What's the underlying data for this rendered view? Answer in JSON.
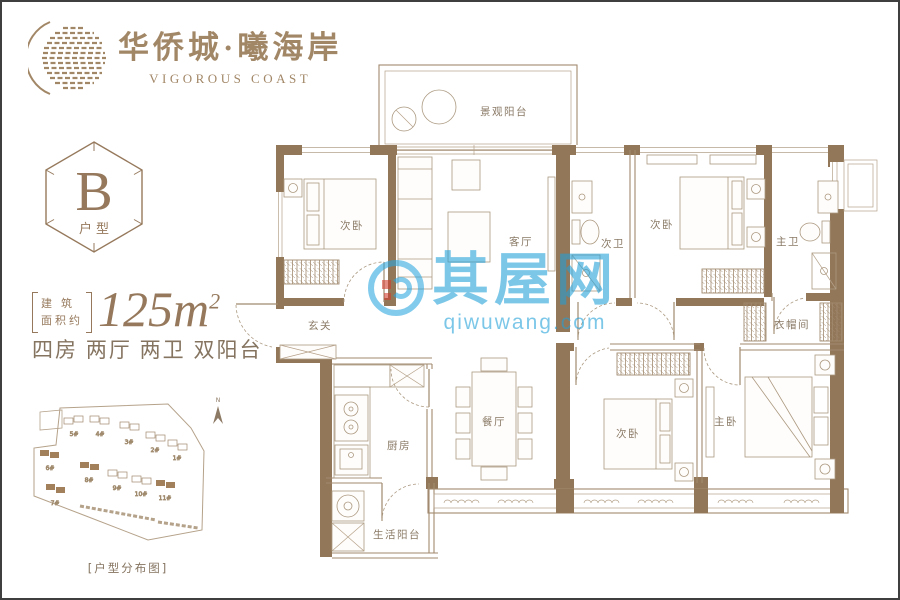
{
  "brand": {
    "title_cn": "华侨城·曦海岸",
    "title_en": "VIGOROUS COAST",
    "color": "#a28767"
  },
  "unit_badge": {
    "letter": "B",
    "label": "户型"
  },
  "area": {
    "bracket_top": "建 筑",
    "bracket_bottom": "面积约",
    "value": "125m",
    "sup": "2",
    "layout_desc": "四房 两厅 两卫 双阳台"
  },
  "site_plan": {
    "north": "N",
    "caption": "[户型分布图]",
    "buildings": [
      {
        "label": "5#",
        "highlight": false
      },
      {
        "label": "4#",
        "highlight": false
      },
      {
        "label": "3#",
        "highlight": false
      },
      {
        "label": "2#",
        "highlight": false
      },
      {
        "label": "1#",
        "highlight": false
      },
      {
        "label": "6#",
        "highlight": true
      },
      {
        "label": "8#",
        "highlight": true
      },
      {
        "label": "9#",
        "highlight": false
      },
      {
        "label": "10#",
        "highlight": false
      },
      {
        "label": "11#",
        "highlight": true
      },
      {
        "label": "7#",
        "highlight": true
      }
    ]
  },
  "floor_plan": {
    "rooms": {
      "view_balcony": "景观阳台",
      "bedroom_a": "次卧",
      "living": "客厅",
      "bath_second": "次卫",
      "bedroom_b": "次卧",
      "master_bath": "主卫",
      "foyer": "玄关",
      "kitchen": "厨房",
      "service_balcony": "生活阳台",
      "dining": "餐厅",
      "bedroom_c": "次卧",
      "master_bedroom": "主卧",
      "cloakroom": "衣帽间"
    }
  },
  "watermark": {
    "name": "其屋网",
    "domain": "qiwuwang.com",
    "color": "#2aa6e0"
  },
  "colors": {
    "wall": "#937759",
    "line": "#a18a6f",
    "brand": "#a28767",
    "label": "#8a7a66"
  }
}
